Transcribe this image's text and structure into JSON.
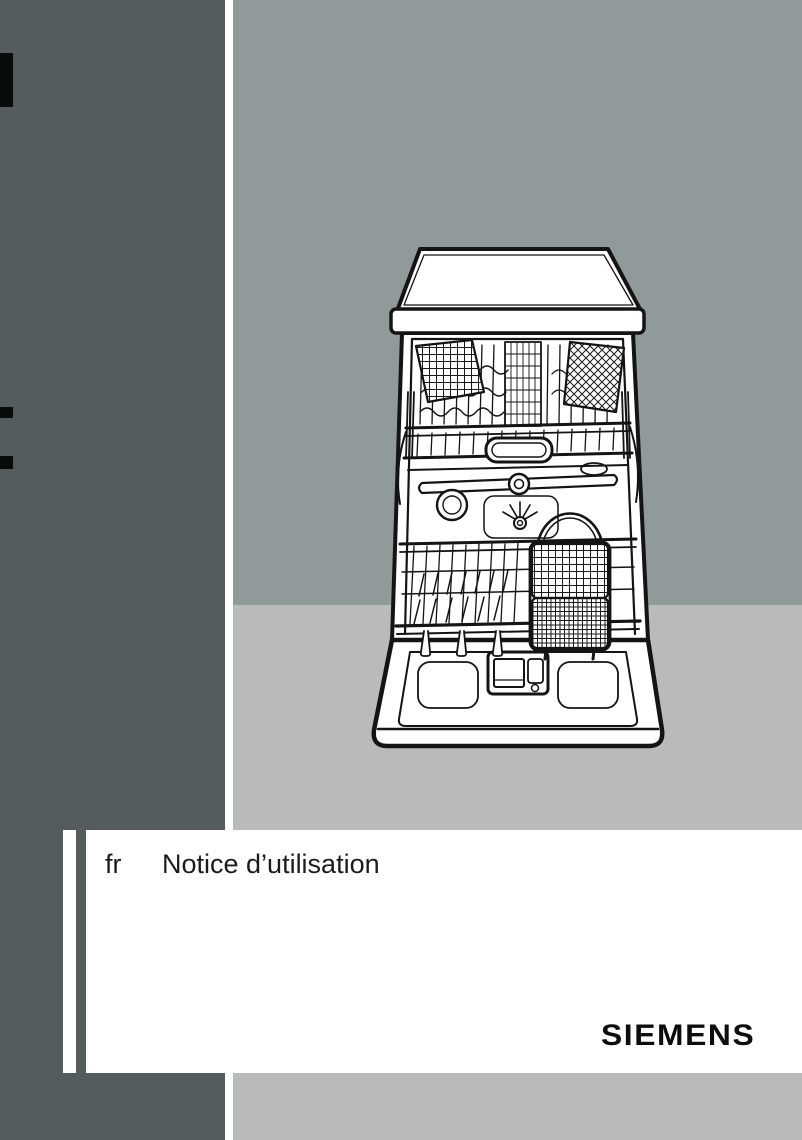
{
  "document": {
    "language_code": "fr",
    "title": "Notice d’utilisation",
    "brand_logo": "SIEMENS"
  },
  "illustration": {
    "name": "open-dishwasher-line-drawing"
  },
  "colors": {
    "dark_band": "#545c5e",
    "backdrop_sage": "#919a9a",
    "backdrop_light_gray": "#b8bbba",
    "page_white": "#ffffff",
    "ink_black": "#141414"
  }
}
